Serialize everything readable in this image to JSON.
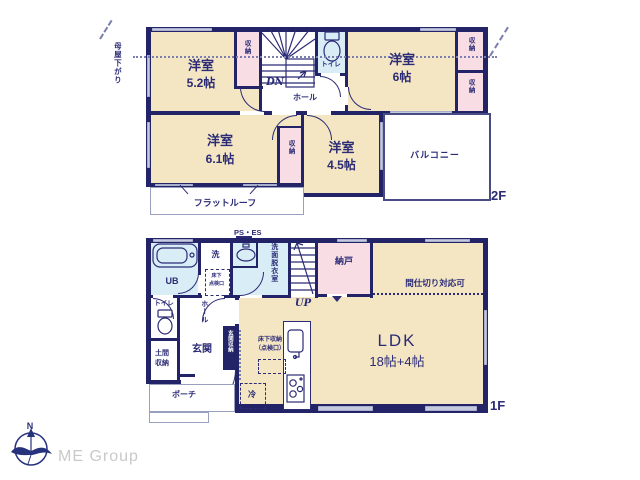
{
  "floor2": {
    "label": "2F",
    "labels": {
      "room": "洋室",
      "size_5_2": "5.2帖",
      "size_6": "6帖",
      "size_6_1": "6.1帖",
      "size_4_5": "4.5帖",
      "closet": "収納",
      "toilet": "トイレ",
      "hall": "ホール",
      "stairs_down": "DN",
      "balcony": "バルコニー",
      "flat_roof": "フラットルーフ",
      "eaves_note": "母屋下がり"
    }
  },
  "floor1": {
    "label": "1F",
    "labels": {
      "ldk": "LDK",
      "ldk_size": "18帖+4帖",
      "partition_note": "間仕切り対応可",
      "storeroom": "納戸",
      "stairs_up": "UP",
      "unit_bath": "UB",
      "washer": "洗",
      "washroom": "洗面脱衣室",
      "pipe_space": "PS・ES",
      "underfloor_hatch_line1": "床下",
      "underfloor_hatch_line2": "点検口",
      "toilet": "トイレ",
      "hall": "ホール",
      "entrance": "玄関",
      "entrance_storage": "玄関収納",
      "doma_storage_line1": "土間",
      "doma_storage_line2": "収納",
      "porch": "ポーチ",
      "underfloor_storage_line1": "床下収納",
      "underfloor_storage_line2": "（点検口）",
      "fridge": "冷"
    }
  },
  "footer": {
    "compass_north": "N",
    "brand": "ME Group"
  },
  "colors": {
    "wall": "#232368",
    "room_fill": "#f4e6c3",
    "closet_fill": "#f8dde4",
    "wet_area_fill": "#d9edf6",
    "window": "#c6cadf",
    "text": "#2b2b76",
    "brand_text": "#c9c9c9"
  }
}
